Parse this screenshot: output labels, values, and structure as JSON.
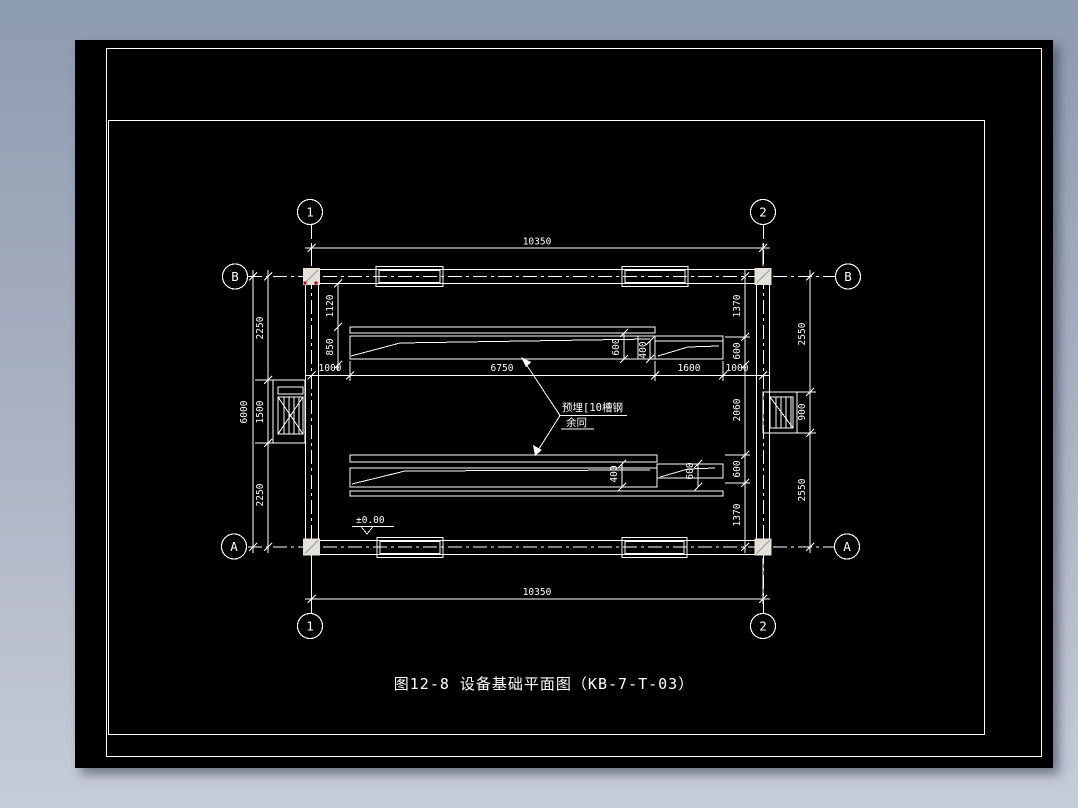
{
  "colors": {
    "background_top": "#8d9bb0",
    "background_bottom": "#c6ccd8",
    "paper": "#000000",
    "line": "#ffffff",
    "grip_red": "#cc0000",
    "column_fill": "#e2e2da"
  },
  "title": {
    "text": "图12-8 设备基础平面图（KB-7-T-03）"
  },
  "grid": {
    "col_1": "1",
    "col_2": "2",
    "row_b": "B",
    "row_a": "A"
  },
  "dims": {
    "span_top": "10350",
    "span_bottom": "10350",
    "height_total": "6000",
    "left_chain": [
      "2250",
      "1500",
      "2250"
    ],
    "right_chain": [
      "1370",
      "600",
      "2060",
      "600",
      "1370"
    ],
    "right_outer_chain": [
      "2550",
      "900",
      "2550"
    ],
    "mid_chain": [
      "1000",
      "6750",
      "1600",
      "1000"
    ],
    "upper_beam_left": [
      "1120",
      "850"
    ],
    "upper_beam_right": [
      "600",
      "400"
    ],
    "lower_beam": [
      "400",
      "600"
    ],
    "level": "±0.00"
  },
  "note": {
    "line1": "预埋[10槽钢",
    "line2": "余同"
  }
}
